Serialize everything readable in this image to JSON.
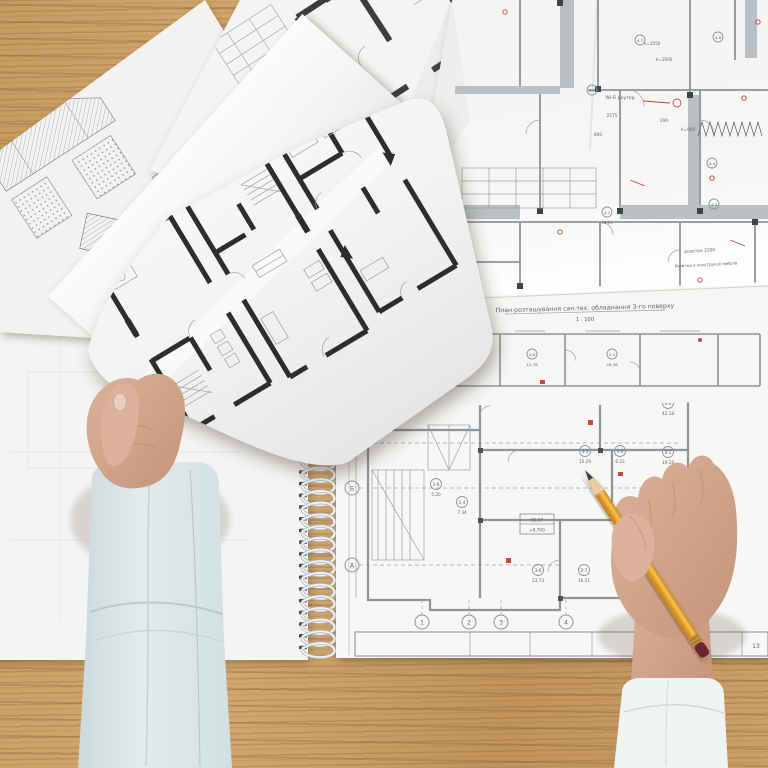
{
  "scene": {
    "alt": "Top-down photo of an architect's wooden desk: two hands over spread architectural floor plans; left hand holds a loose plan sheet, right hand points a yellow pencil at a spiral-bound blueprint"
  },
  "colors": {
    "wood": "#C89B61",
    "wood_grain": "#8F6B3E",
    "paper": "#F6F6F4",
    "paper_shadow": "#E2E3E6",
    "plan_line": "#8D939A",
    "wall_dark": "#2E2F31",
    "wall_gray": "#B9BFC3",
    "annotation_red": "#C14B3C",
    "skin": "#D7AB93",
    "sleeve_left": "#DDE7E9",
    "sleeve_right": "#EFF4F3",
    "pencil_body": "#EDA93C",
    "pencil_end": "#6E2030",
    "coil": "#EFF1F3"
  },
  "blueprint": {
    "title": "План розташування сан.тех. обладнання 3-го поверху",
    "scale": "1 : 100",
    "annotations": {
      "wifi": "Wi-Fi роутер",
      "sockets": "розетки 220V",
      "furniture_sockets": "Розетки в конструкції меблів"
    },
    "dimensions": [
      "2575",
      "600",
      "290",
      "h=900",
      "h=1050",
      "h=1600"
    ],
    "rooms": [
      {
        "tag": "4-5"
      },
      {
        "tag": "4-7"
      },
      {
        "tag": "4-8"
      },
      {
        "tag": "4-4"
      },
      {
        "tag": "4-3"
      },
      {
        "tag": "4-2",
        "area": "18.21"
      }
    ],
    "strip_rooms": [
      {
        "tag": "4-7",
        "area": "13.37"
      },
      {
        "tag": "4-8",
        "area": "5.32"
      },
      {
        "tag": "4-6",
        "area": "12.76"
      },
      {
        "tag": "5-1",
        "area": "26.26"
      }
    ]
  },
  "notebook_plan": {
    "grid_rows": [
      "В",
      "Б",
      "А"
    ],
    "grid_cols": [
      "1",
      "2",
      "3",
      "4"
    ],
    "rooms": [
      {
        "tag": "4-3",
        "area": "15.29"
      },
      {
        "tag": "5-4",
        "area": "6.23"
      },
      {
        "tag": "1-6",
        "area": "5.20"
      },
      {
        "tag": "1-4",
        "area": "7.34"
      },
      {
        "tag": "3-6",
        "area": "23.73"
      },
      {
        "tag": "2-7",
        "area": "16.51"
      },
      {
        "tag": "4-4",
        "area": "42.18"
      },
      {
        "tag": "4-1",
        "area": "19.28"
      }
    ],
    "level_mark": {
      "area": "85.27",
      "elevation": "+8.700"
    },
    "titleblock_text": "поверху",
    "page_number": "13"
  }
}
